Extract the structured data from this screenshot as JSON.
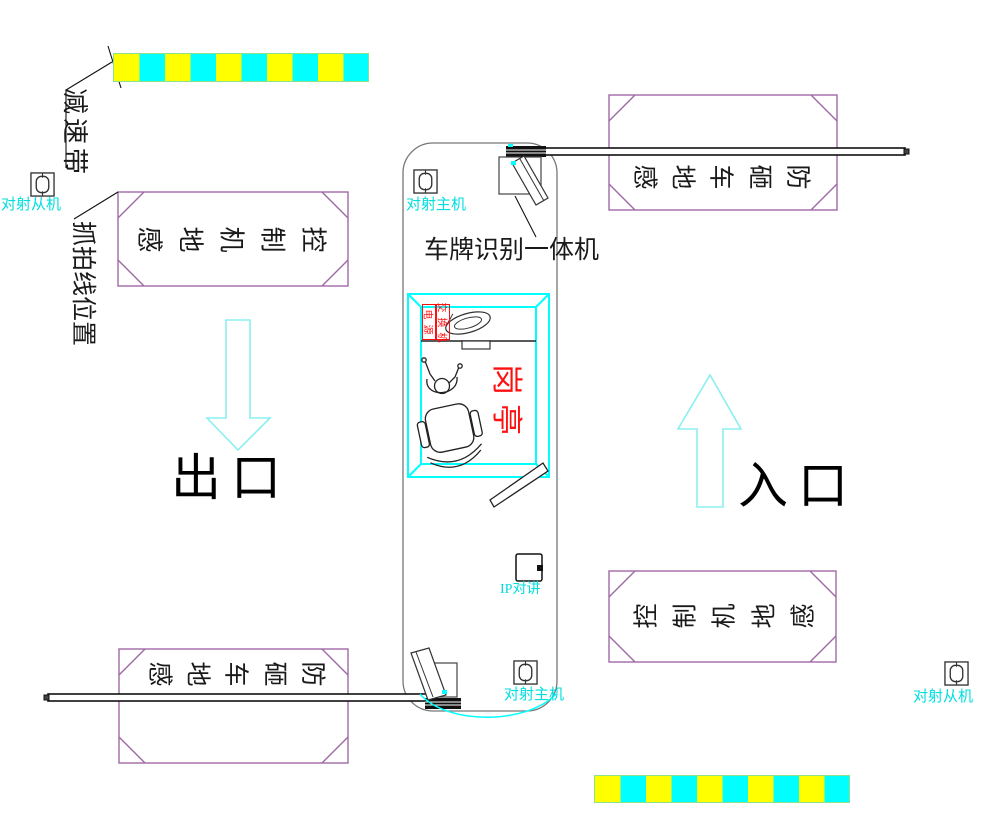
{
  "colors": {
    "label-cyan": "#00dede",
    "wall-cyan": "#00ffff",
    "arrow-cyan": "#8cefef",
    "purple": "#a06aa6",
    "red": "#ff1010",
    "yellow": "#ffff00",
    "bump-cyan": "#00ffff"
  },
  "labels": {
    "speed_bump": "减速带",
    "capture_line_position": "抓拍线位置",
    "beam_slave": "对射从机",
    "beam_master": "对射主机",
    "lpr_machine": "车牌识别一体机",
    "exit": "出口",
    "entrance": "入口",
    "guard_booth": "岗亭",
    "switch_unit": "交换机",
    "power": "电源",
    "ip_intercom": "IP对讲",
    "control_ground_sensor": "控制机地感",
    "anti_smash_ground_sensor": "防砸车地感"
  }
}
